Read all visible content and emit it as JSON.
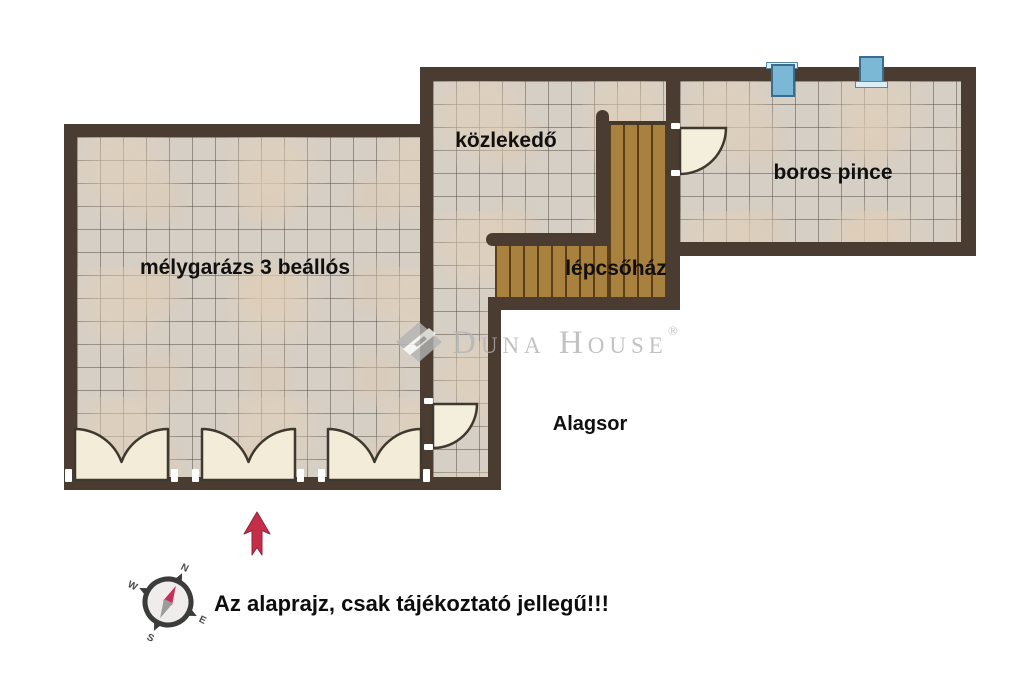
{
  "plan": {
    "rooms": {
      "garage": {
        "label": "mélygarázs 3 beállós"
      },
      "hallway": {
        "label": "közlekedő"
      },
      "staircase": {
        "label": "lépcsőház"
      },
      "wine_cellar": {
        "label": "boros pince"
      }
    },
    "floor": {
      "label": "Alagsor"
    },
    "disclaimer": {
      "text": "Az alaprajz, csak tájékoztató jellegű!!!"
    },
    "watermark": {
      "brand": "Duna House",
      "reg": "®"
    },
    "compass": {
      "north": "N",
      "east": "E",
      "south": "S",
      "west": "W"
    },
    "colors": {
      "wall": "#4a3c31",
      "floor_tile": "#d6cfc6",
      "tile_grid_line": "#5c544a",
      "stair_wood": "#a8813f",
      "door_leaf": "#f2ecd9",
      "window_blue": "#7ab8d6",
      "north_arrow_red": "#c52e49",
      "watermark_gray": "#b4b4b4"
    }
  }
}
